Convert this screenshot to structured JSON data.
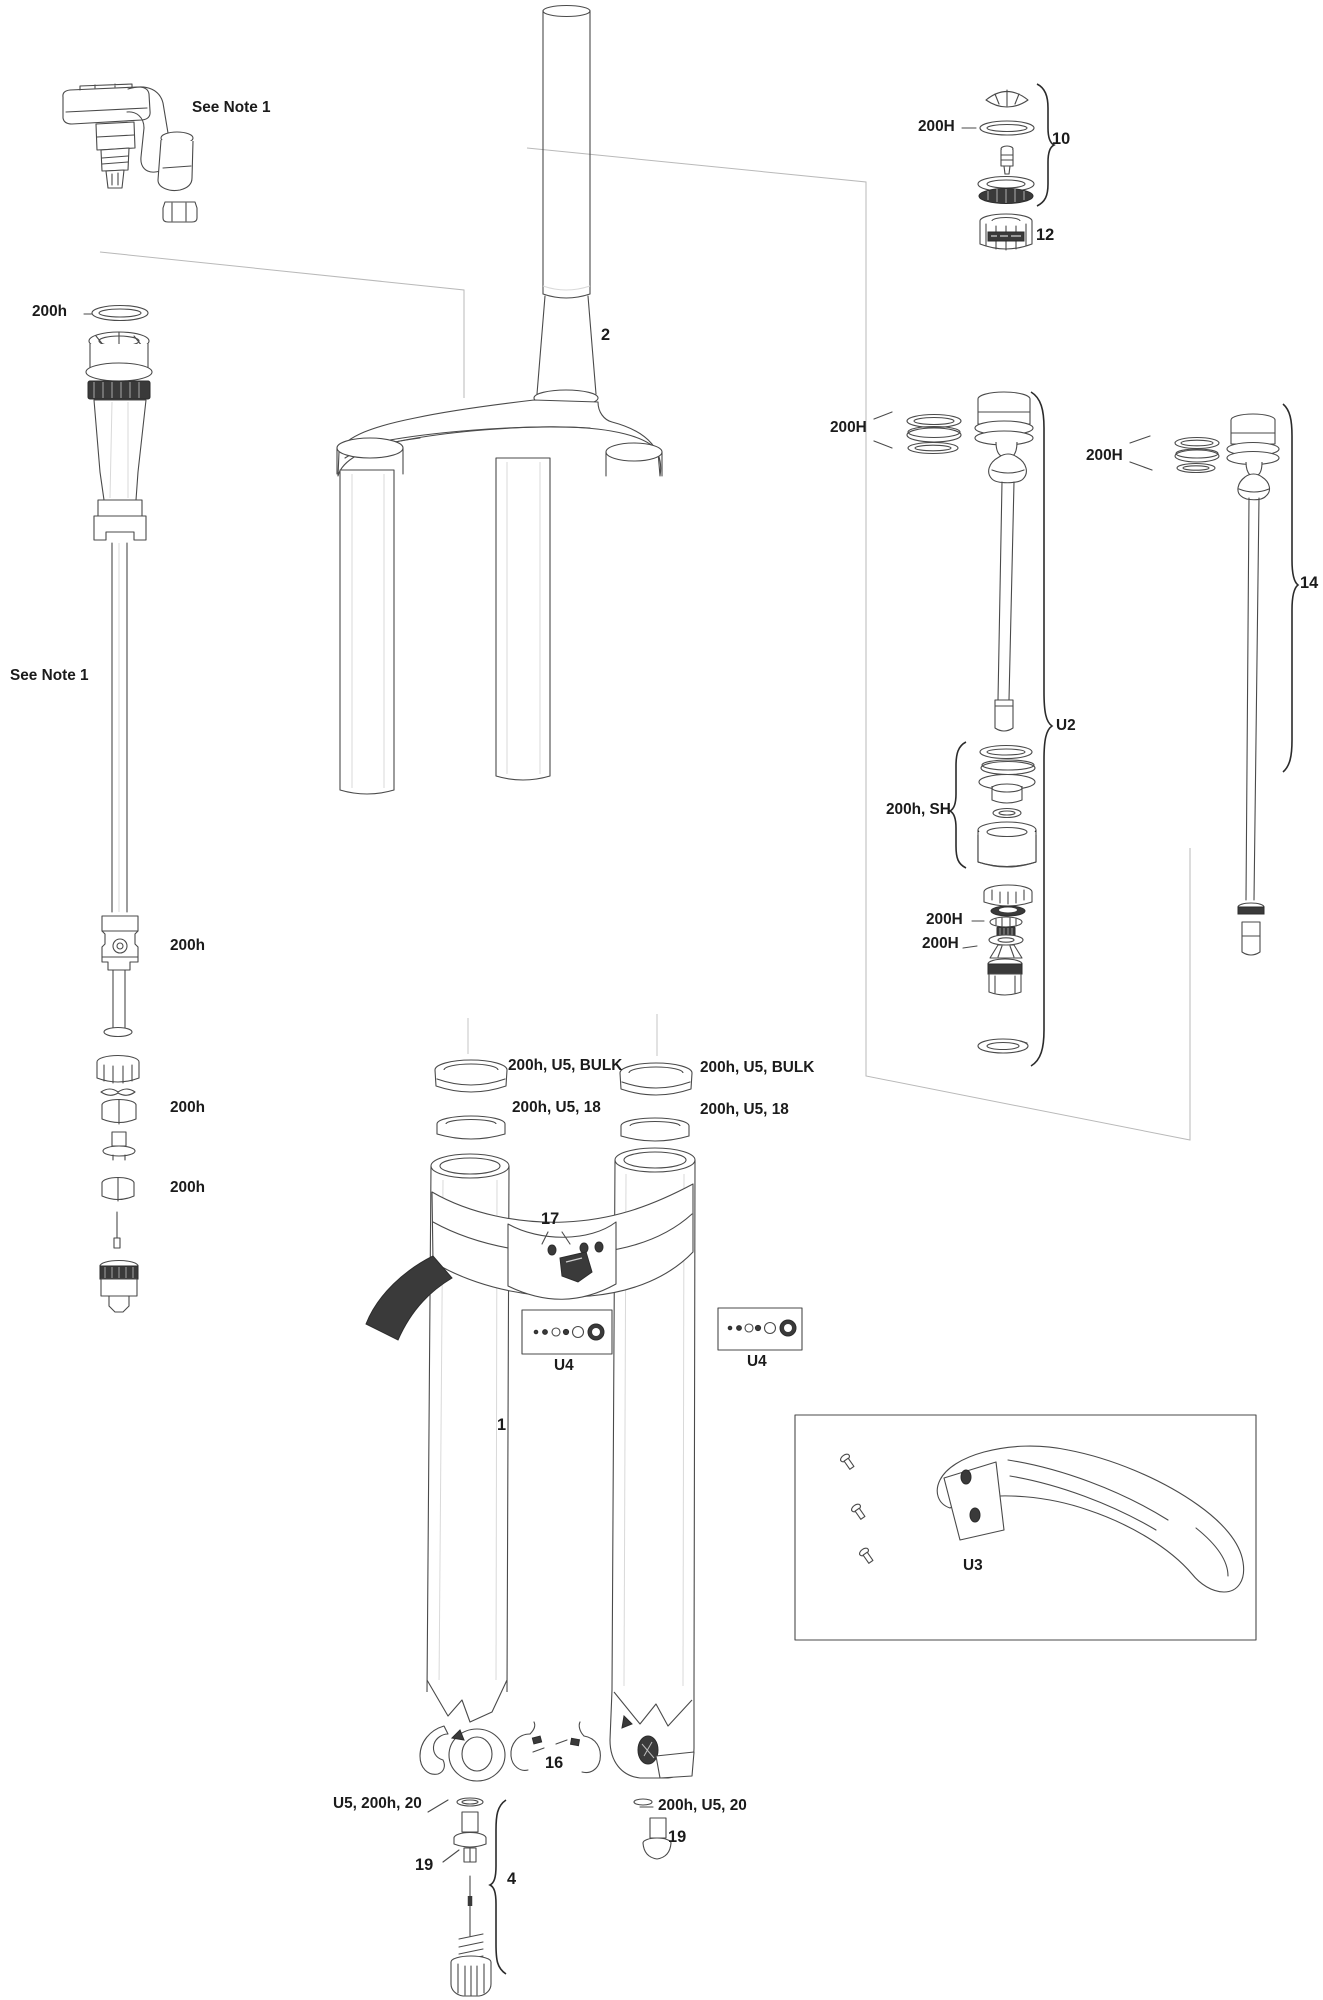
{
  "document": {
    "kind": "suspension-fork exploded parts diagram",
    "background": "#ffffff",
    "line_color": "#4a4a4a",
    "dark_fill": "#3a3a3a",
    "reference_line_color": "#b9b9b9",
    "label_color": "#1b1b1b"
  },
  "labels": {
    "note1_top": "See Note 1",
    "note1_left": "See Note 1",
    "airtop_200h": "200h",
    "piston_200h": "200h",
    "cup1_200h": "200h",
    "cup2_200h": "200h",
    "steerer_2": "2",
    "g10_200H": "200H",
    "g10": "10",
    "g12": "12",
    "damper_200H": "200H",
    "u2": "U2",
    "sh_group": "200h, SH",
    "lower_200H_a": "200H",
    "lower_200H_b": "200H",
    "right_200H": "200H",
    "g14": "14",
    "bulk_left": "200h, U5, BULK",
    "bulk_right": "200h, U5, BULK",
    "g18_left": "200h, U5, 18",
    "g18_right": "200h, U5, 18",
    "g17": "17",
    "u4_left": "U4",
    "u4_right": "U4",
    "lowers_1": "1",
    "u3": "U3",
    "g16": "16",
    "bolt_left": "U5, 200h, 20",
    "g19_left": "19",
    "g4": "4",
    "bolt_right": "200h, U5, 20",
    "g19_right": "19"
  }
}
